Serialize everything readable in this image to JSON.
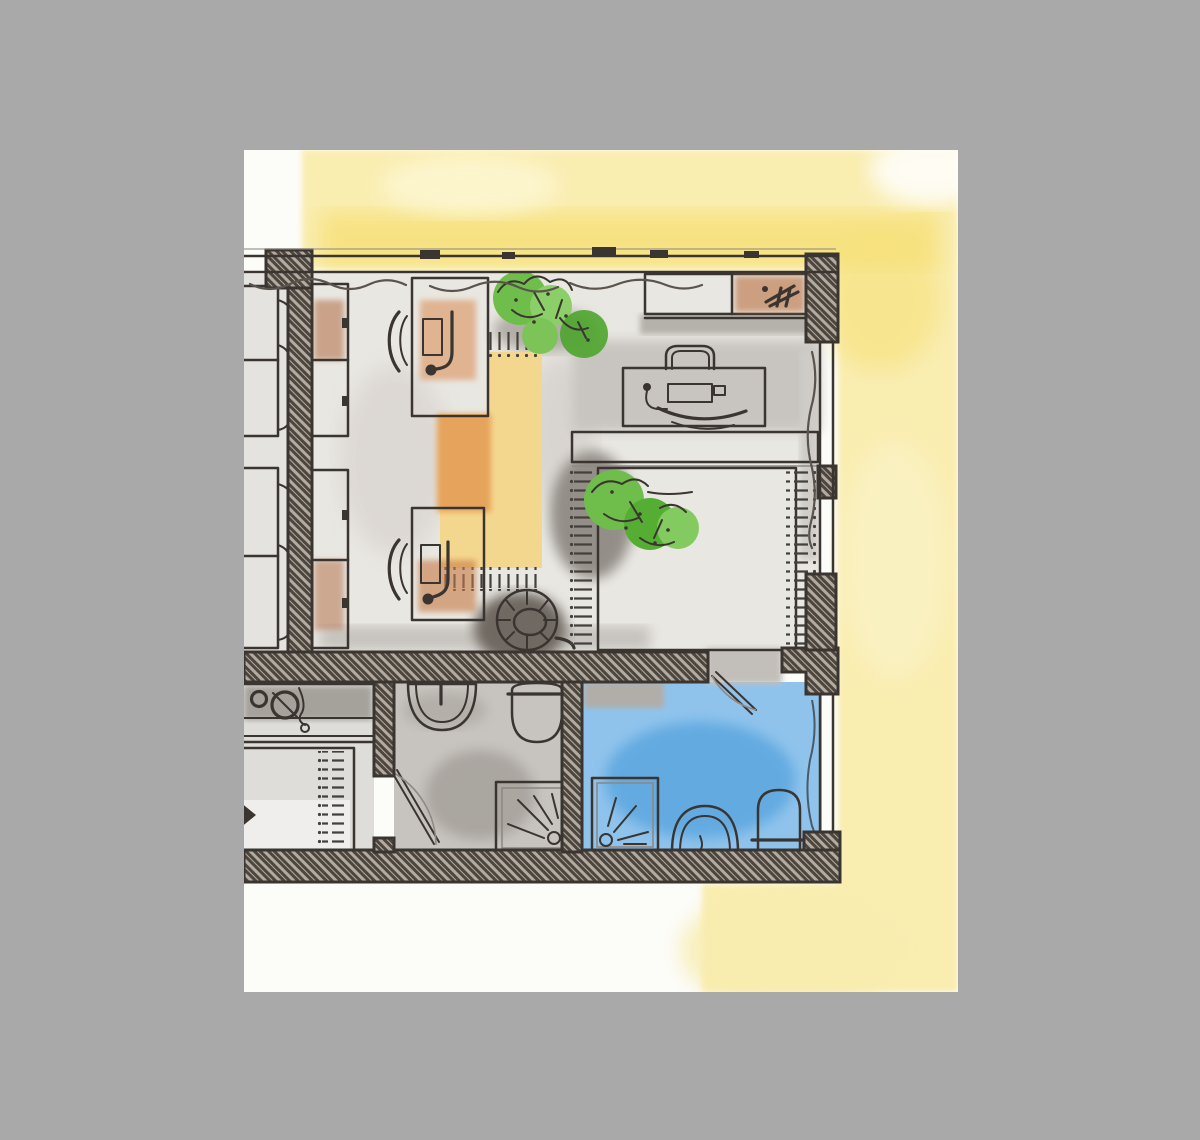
{
  "artwork": {
    "title": "watercolor-floor-plan-sketch",
    "description": "Hand-drawn top-down watercolor floor plan of a small apartment on white paper with a yellow wash, framed by a plain gray backdrop",
    "rooms": [
      {
        "name": "studio-office-room",
        "objects": [
          "wardrobe-cabinets",
          "sofa-cropped",
          "desk-with-keyboard-and-lamp",
          "office-chair",
          "second-desk-with-keyboard-and-lamp",
          "second-office-chair",
          "yellow-rug",
          "potted-plants",
          "red-stool"
        ]
      },
      {
        "name": "bedroom-office",
        "objects": [
          "sideboard",
          "desk-chair",
          "desk-with-keyboard",
          "wall-shelf",
          "double-bed",
          "potted-plants",
          "window-band"
        ]
      },
      {
        "name": "kitchen-cropped",
        "objects": [
          "counter-with-sink-and-hob",
          "fringed-bed-or-table"
        ]
      },
      {
        "name": "wc-room",
        "objects": [
          "washbasin",
          "wall-hung-toilet",
          "shower-tray",
          "door-leaf"
        ]
      },
      {
        "name": "blue-bathroom",
        "objects": [
          "shower-tray",
          "washbasin",
          "toilet",
          "door-leaf",
          "window-band"
        ]
      }
    ]
  },
  "colors": {
    "backdrop": "#a9a9a9",
    "paper": "#fcfcf9",
    "wash_yellow": "#f9edb0",
    "wash_yellow_deep": "#f7e17c",
    "pen": "#3a3531",
    "wall_fill": "#b3aba1",
    "wall_hatch": "#4d463e",
    "floor_light": "#e9e7e2",
    "floor_gray": "#c7c4bf",
    "shadow_gray": "#8f8a84",
    "water_blue": "#8fc3ec",
    "water_blue_deep": "#5ea8e0",
    "furniture_orange": "#c9875b",
    "furniture_orange_deep": "#b06a42",
    "desk_tan": "#e9b98f",
    "desk_tan_light": "#f0d2ab",
    "shelf_tan": "#ecc49d",
    "rug_yellow": "#f4d78e",
    "rug_orange": "#e5a35c",
    "plant_green": "#6fbe4b",
    "plant_green_dark": "#4ea52e",
    "plant_green_light": "#8ccf68",
    "stool_red": "#dd4f2f",
    "stool_center": "#8b8077",
    "sofa_gray": "#ccc9c5",
    "white": "#fdfdfb"
  }
}
